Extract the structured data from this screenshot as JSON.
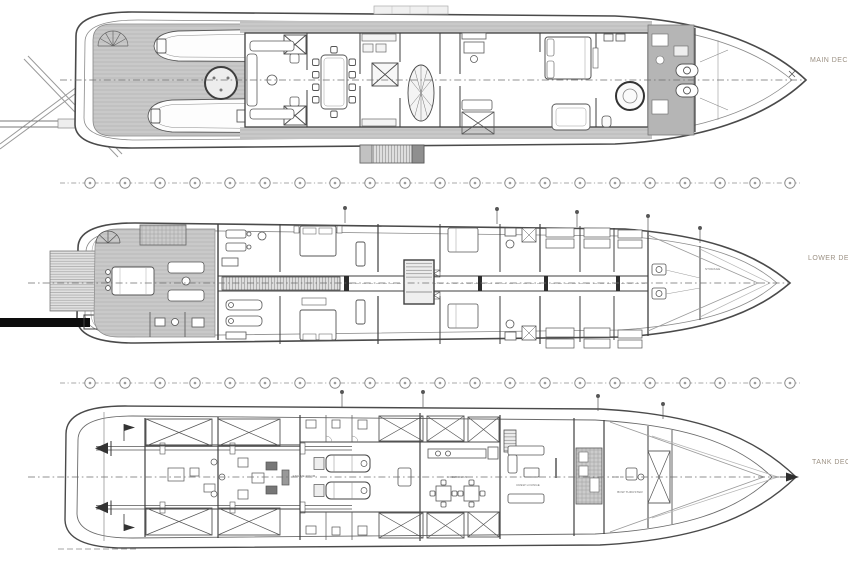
{
  "document": {
    "type": "yacht-general-arrangement-plan",
    "background": "#ffffff"
  },
  "palette": {
    "ink": "#4a4a4a",
    "deck_gray": "#c9c9c9",
    "gangway_black": "#0d0d0d",
    "label_gray": "#9c9184"
  },
  "decks": [
    {
      "id": "main-deck",
      "label": "MAIN DECK"
    },
    {
      "id": "lower-deck",
      "label": "LOWER DECK"
    },
    {
      "id": "tank-deck",
      "label": "TANK DECK"
    }
  ],
  "room_labels": {
    "storage": "STORAGE",
    "engine_room": "ENGINE ROOM",
    "crew_mess": "CREW MESS",
    "crew_lounge": "CREW LOUNGE",
    "bow_thruster": "BOW THRUSTER"
  },
  "frame_rows": [
    {
      "y": 183,
      "line_start": 60,
      "line_end": 800,
      "first_circle_x": 90,
      "spacing": 35,
      "count": 21
    },
    {
      "y": 383,
      "line_start": 60,
      "line_end": 800,
      "first_circle_x": 90,
      "spacing": 35,
      "count": 21
    }
  ]
}
